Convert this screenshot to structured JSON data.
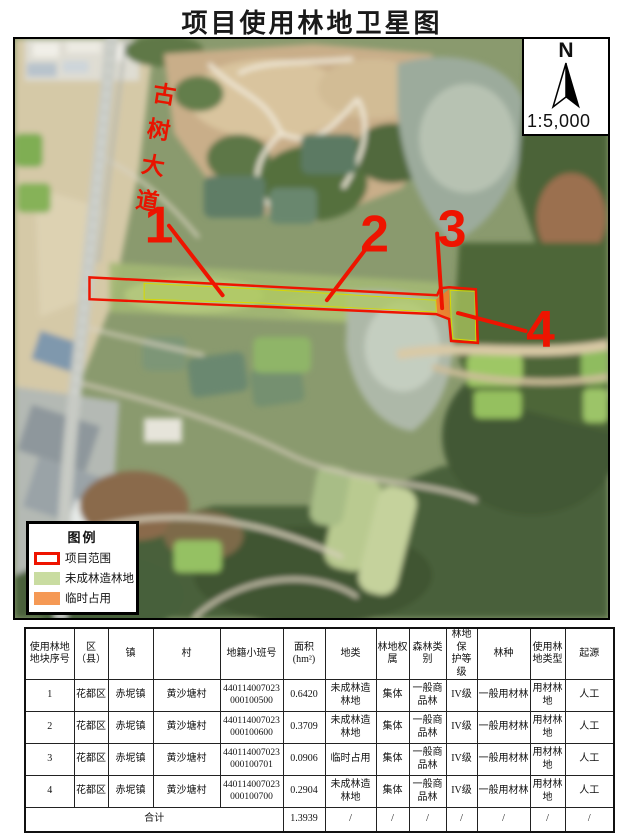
{
  "page": {
    "title": "项目使用林地卫星图"
  },
  "map": {
    "compass": {
      "north_label": "N",
      "scale_label": "1:5,000"
    },
    "road_label": "古树大道",
    "markers": [
      {
        "label": "1"
      },
      {
        "label": "2"
      },
      {
        "label": "3"
      },
      {
        "label": "4"
      }
    ],
    "legend": {
      "title": "图例",
      "items": [
        {
          "label": "项目范围",
          "swatch": "outline",
          "color": "#ee1400"
        },
        {
          "label": "未成林造林地",
          "swatch": "fill",
          "color": "#c9dca1"
        },
        {
          "label": "临时占用",
          "swatch": "fill",
          "color": "#f59955"
        }
      ]
    },
    "annotation_colors": {
      "boundary_red": "#ee1400",
      "fill_green": "#b0cb60",
      "fill_orange": "#f27d28"
    }
  },
  "table": {
    "headers": [
      "使用林地\n地块序号",
      "区\n（县）",
      "镇",
      "村",
      "地籍小班号",
      "面积\n(hm²)",
      "地类",
      "林地权\n属",
      "森林类\n别",
      "林地保\n护等级",
      "林种",
      "使用林\n地类型",
      "起源"
    ],
    "rows": [
      [
        "1",
        "花都区",
        "赤坭镇",
        "黄沙塘村",
        "440114007023000100500",
        "0.6420",
        "未成林造林地",
        "集体",
        "一般商品林",
        "IV级",
        "一般用材林",
        "用材林地",
        "人工"
      ],
      [
        "2",
        "花都区",
        "赤坭镇",
        "黄沙塘村",
        "440114007023000100600",
        "0.3709",
        "未成林造林地",
        "集体",
        "一般商品林",
        "IV级",
        "一般用材林",
        "用材林地",
        "人工"
      ],
      [
        "3",
        "花都区",
        "赤坭镇",
        "黄沙塘村",
        "440114007023000100701",
        "0.0906",
        "临时占用",
        "集体",
        "一般商品林",
        "IV级",
        "一般用材林",
        "用材林地",
        "人工"
      ],
      [
        "4",
        "花都区",
        "赤坭镇",
        "黄沙塘村",
        "440114007023000100700",
        "0.2904",
        "未成林造林地",
        "集体",
        "一般商品林",
        "IV级",
        "一般用材林",
        "用材林地",
        "人工"
      ]
    ],
    "total": {
      "label": "合计",
      "area": "1.3939",
      "slash": "/"
    }
  }
}
